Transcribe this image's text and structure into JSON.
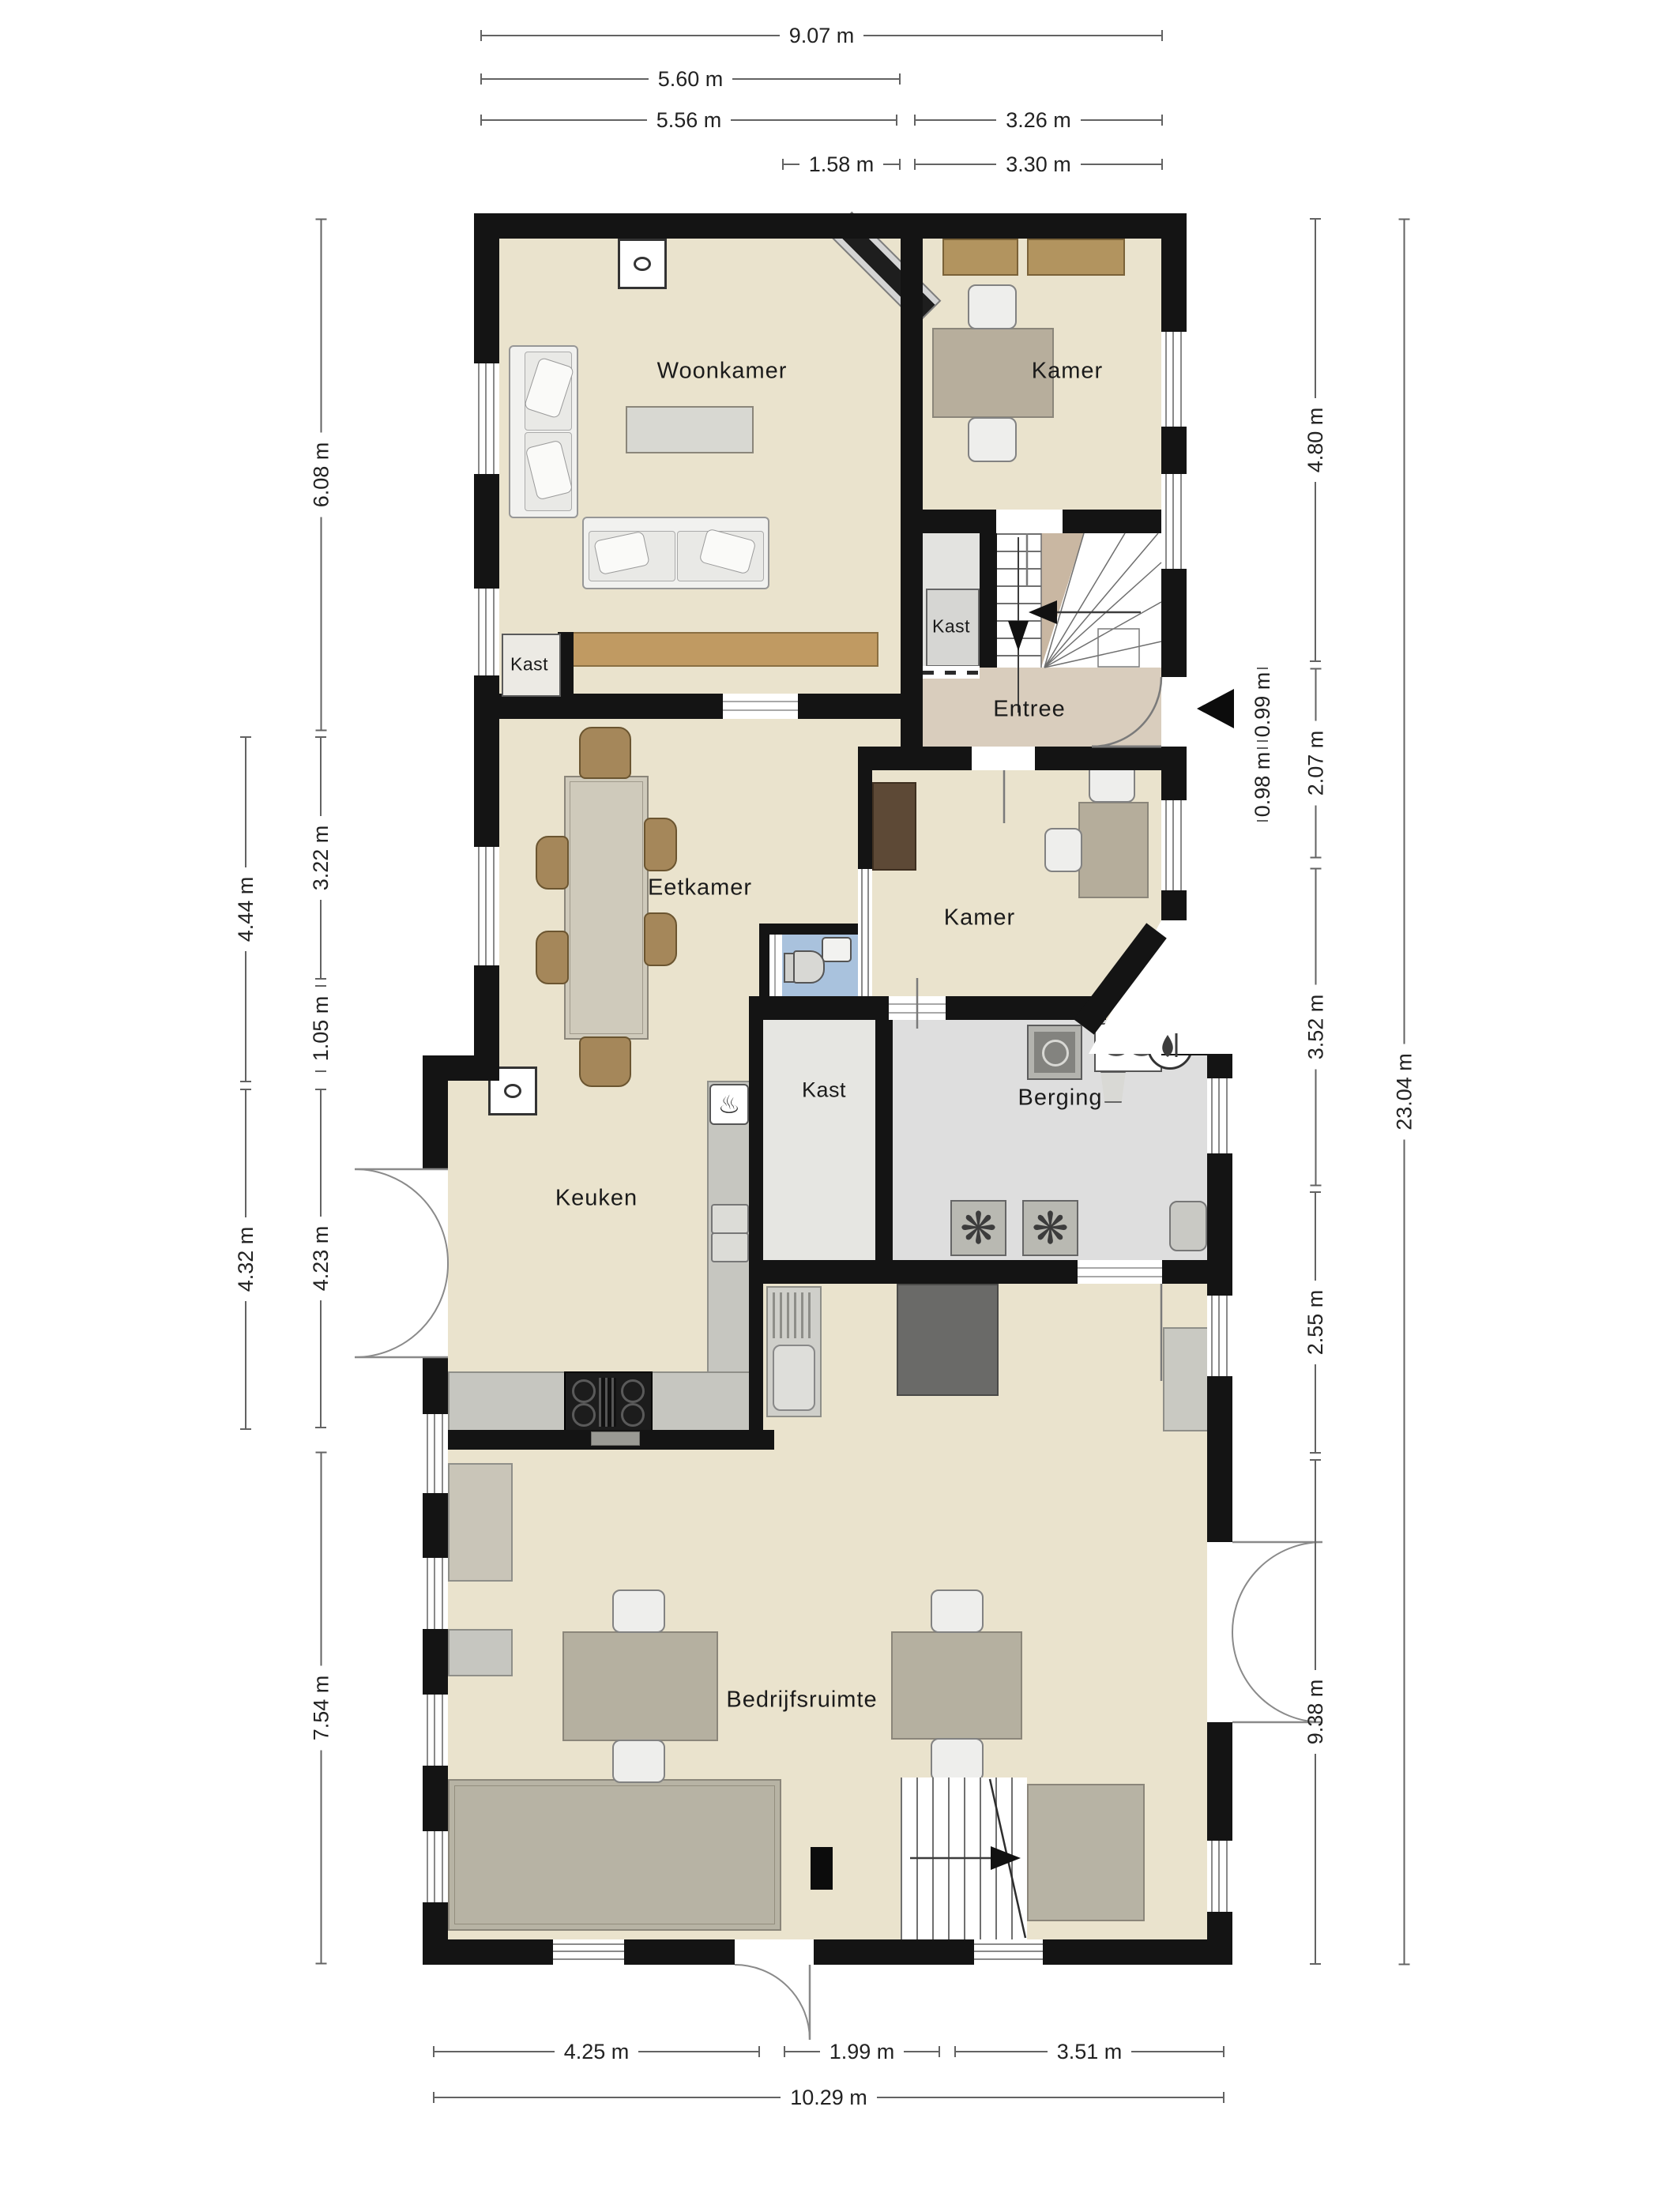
{
  "colors": {
    "wall": "#141414",
    "floor_main": "#eae3cd",
    "floor_entree": "#d9cdbd",
    "floor_utility": "#dedede",
    "floor_kast": "#e6e6e2",
    "floor_toilet": "#a9c2dd",
    "furniture_gray": "#c6c6c0",
    "wood": "#c09a62",
    "dim_line": "#636363"
  },
  "rooms": {
    "woonkamer": "Woonkamer",
    "kamer_boven": "Kamer",
    "kast_woonkamer": "Kast",
    "kast_entree": "Kast",
    "entree": "Entree",
    "eetkamer": "Eetkamer",
    "kamer_midden": "Kamer",
    "keuken": "Keuken",
    "kast_midden": "Kast",
    "berging": "Berging",
    "bedrijfsruimte": "Bedrijfsruimte"
  },
  "dimensions": {
    "top": [
      "9.07 m",
      "5.60 m",
      "5.56 m",
      "3.26 m",
      "1.58 m",
      "3.30 m"
    ],
    "left_inner": [
      "6.08 m",
      "3.22 m",
      "1.05 m",
      "4.23 m",
      "7.54 m"
    ],
    "left_outer": [
      "4.44 m",
      "4.32 m"
    ],
    "right_inner": [
      "4.80 m",
      "2.07 m",
      "3.52 m",
      "2.55 m",
      "9.38 m"
    ],
    "right_small": [
      "0.99 m",
      "0.98 m"
    ],
    "right_outer": [
      "23.04 m"
    ],
    "bottom": [
      "4.25 m",
      "1.99 m",
      "3.51 m",
      "10.29 m"
    ]
  },
  "icons": {
    "fan_glyph": "❋",
    "oven_glyph": "♨"
  }
}
